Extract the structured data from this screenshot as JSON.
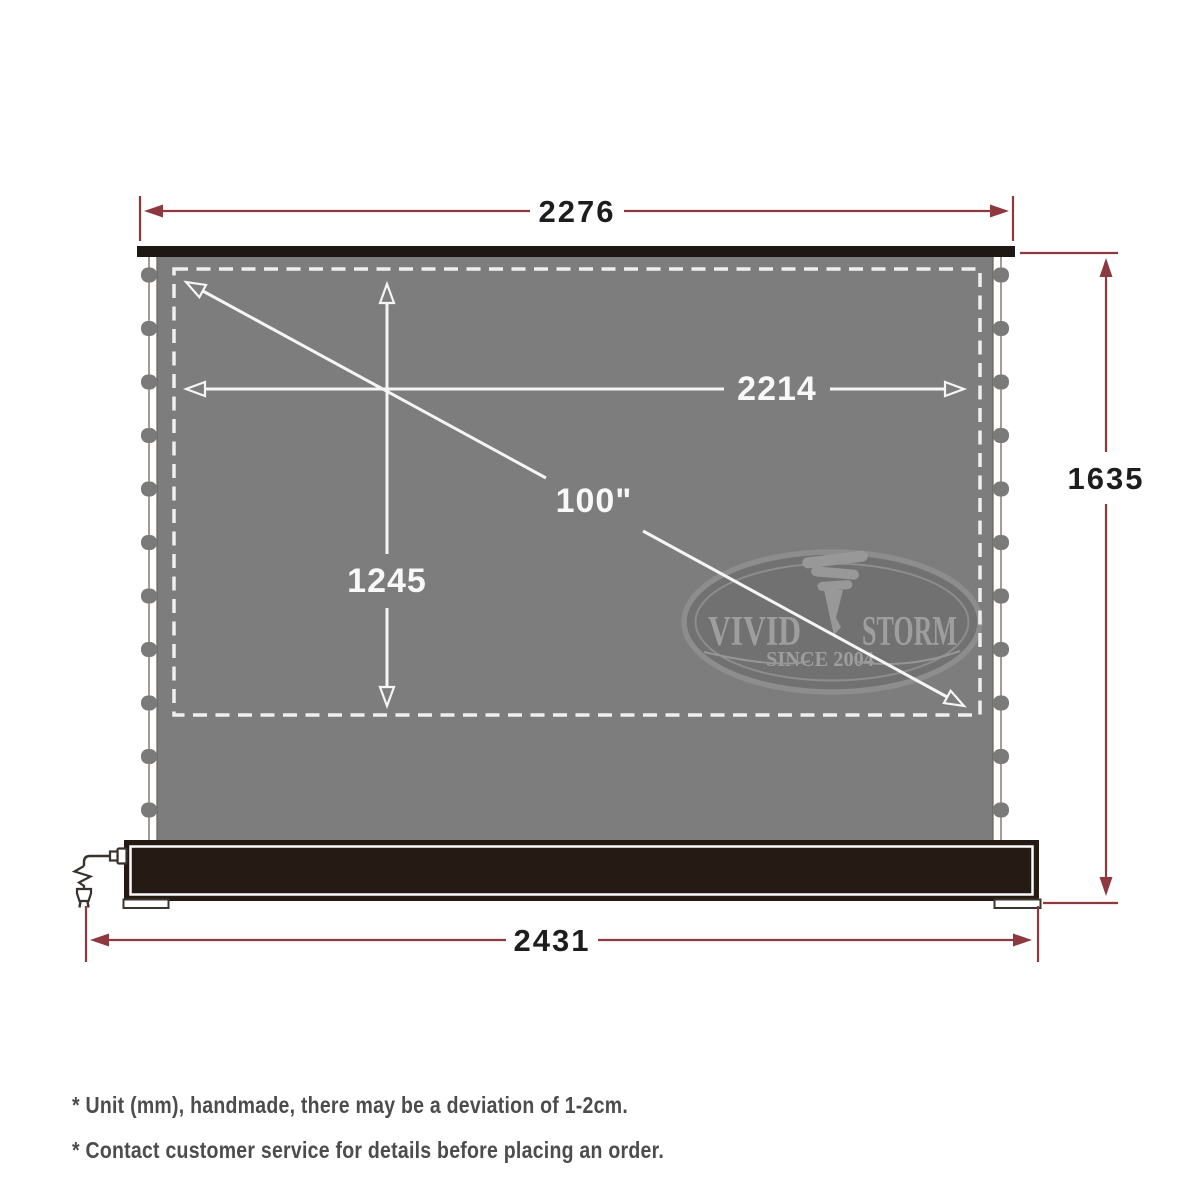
{
  "dimensions": {
    "top_width": "2276",
    "viewing_width": "2214",
    "viewing_height": "1245",
    "diagonal": "100\"",
    "total_height": "1635",
    "base_width": "2431"
  },
  "logo": {
    "brand_left": "VIVID",
    "brand_right": "STORM",
    "tagline": "SINCE 2004"
  },
  "notes": {
    "line1": "* Unit (mm), handmade, there may be a deviation of 1-2cm.",
    "line2": "* Contact customer service for details before placing an order."
  },
  "colors": {
    "dimension_red": "#8c3a3f",
    "screen_gray": "#7d7d7d",
    "base_dark": "#261a14",
    "line_white": "#f5f5f5",
    "dash_white": "#efefef"
  }
}
